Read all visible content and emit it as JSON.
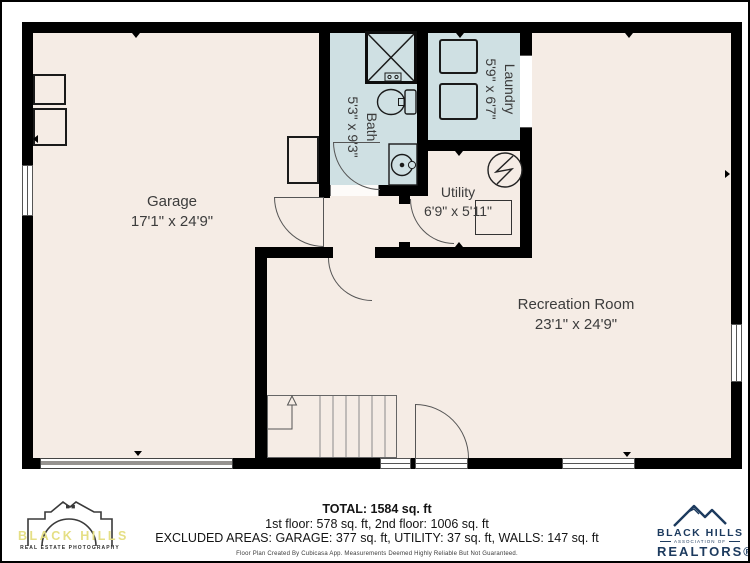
{
  "plan": {
    "rooms": [
      {
        "name": "Garage",
        "dims": "17'1\" x 24'9\""
      },
      {
        "name": "Bath",
        "dims": "5'3\" x 9'3\""
      },
      {
        "name": "Laundry",
        "dims": "5'9\" x 6'7\""
      },
      {
        "name": "Utility",
        "dims": "6'9\" x 5'11\""
      },
      {
        "name": "Recreation Room",
        "dims": "23'1\" x 24'9\""
      }
    ]
  },
  "summary": {
    "total": "TOTAL: 1584 sq. ft",
    "floors": "1st floor: 578 sq. ft, 2nd floor: 1006 sq. ft",
    "excluded_areas": "EXCLUDED AREAS: GARAGE: 377 sq. ft, UTILITY: 37 sq. ft, WALLS: 147 sq. ft",
    "disclaimer": "Floor Plan Created By Cubicasa App. Measurements Deemed Highly Reliable But Not Guaranteed."
  },
  "branding": {
    "photographer": {
      "name": "BLACK HILLS",
      "tagline": "REAL ESTATE PHOTOGRAPHY"
    },
    "association": {
      "name": "BLACK HILLS",
      "subtitle": "ASSOCIATION OF",
      "title": "REALTORS®"
    }
  },
  "colors": {
    "floor": "#f5ece5",
    "wet_room": "#cfe0e3",
    "wall": "#000000",
    "logo_yellow": "#e5df85",
    "logo_navy": "#1c3a5e"
  }
}
